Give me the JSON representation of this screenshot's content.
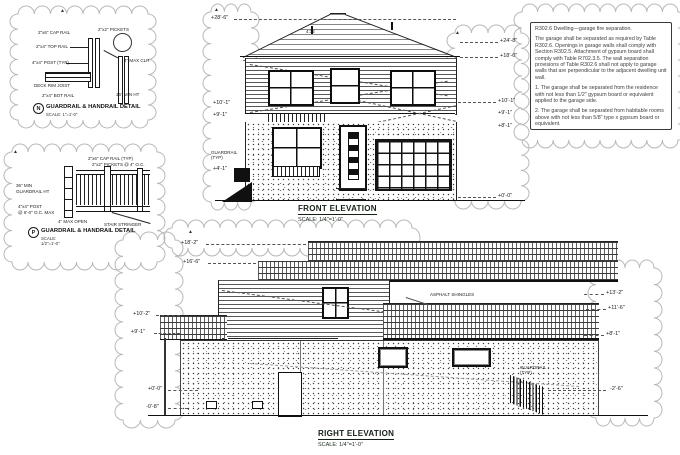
{
  "palette": {
    "line": "#1a1a1a",
    "cloud": "#b8b8b8",
    "paper": "#ffffff"
  },
  "details": {
    "n": {
      "tag": "N",
      "title": "GUARDRAIL & HANDRAIL DETAIL",
      "scale": "SCALE: 1\"=1'-0\"",
      "ann": [
        "2\"x6\" CAP RAIL",
        "2\"x4\" TOP RAIL",
        "4\"x4\" POST (TYP)",
        "DECK RIM JOIST",
        "2\"x4\" BOT RAIL",
        "2\"x2\" PICKETS",
        "4\" MAX CLR",
        "36\" MIN HT"
      ]
    },
    "p": {
      "tag": "P",
      "title": "GUARDRAIL & HANDRAIL DETAIL",
      "scale1": "SCALE:",
      "scale2": "1/2\"=1'-0\"",
      "ann": [
        "2\"x6\" CAP RAIL (TYP)",
        "2\"x2\" PICKETS @ 4\" O.C.",
        "36\" MIN",
        "GUARDRAIL HT",
        "4\"x4\" POST",
        "@ 6'-0\" O.C. MAX",
        "4\" MAX OPEN",
        "STAIR STRINGER"
      ]
    }
  },
  "front": {
    "title": "FRONT ELEVATION",
    "scale": "SCALE: 1/4\"=1'-0\"",
    "pitch": "4:12",
    "guard1": "GUARDRAIL",
    "guard2": "(TYP)",
    "markers_left": [
      "+28'-6\"",
      "+10'-1\"",
      "+9'-1\"",
      "+4'-1\""
    ],
    "markers_right": [
      "+24'-8\"",
      "+18'-6\"",
      "+10'-1\"",
      "+9'-1\"",
      "+8'-1\"",
      "+0'-0\""
    ]
  },
  "right_elev": {
    "title": "RIGHT ELEVATION",
    "scale": "SCALE: 1/4\"=1'-0\"",
    "shingle_note": "ASPHALT SHINGLES",
    "rail1": "GUARDRAIL",
    "rail2": "(TYP)",
    "markers_left": [
      "+18'-2\"",
      "+16'-6\"",
      "+10'-2\"",
      "+9'-1\"",
      "+0'-0\"",
      "-0'-8\""
    ],
    "markers_right": [
      "+13'-2\"",
      "+11'-6\"",
      "+8'-1\"",
      "-2'-6\""
    ]
  },
  "code_note": {
    "heading": "R302.6 Dwelling—garage fire separation.",
    "body": "The garage shall be separated as required by Table R302.6. Openings in garage walls shall comply with Section R302.5. Attachment of gypsum board shall comply with Table R702.3.5. The wall separation provisions of Table R302.6 shall not apply to garage walls that are perpendicular to the adjacent dwelling unit wall.",
    "item1": "1. The garage shall be separated from the residence with not less than 1/2\" gypsum board or equivalent applied to the garage side.",
    "item2": "2. The garage shall be separated from habitable rooms above with not less than 5/8\" type x gypsum board or equivalent."
  }
}
